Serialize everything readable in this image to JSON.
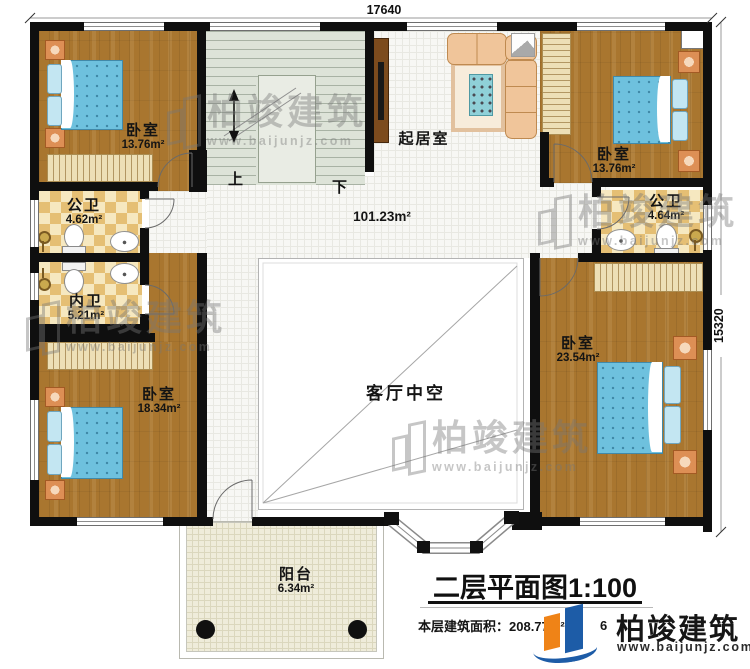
{
  "title": {
    "text": "二层平面图1:100"
  },
  "footer": {
    "area_label": "本层建筑面积：208.77m²",
    "obscured_fragment": "6"
  },
  "brand": {
    "name": "柏竣建筑",
    "url": "www.baijunjz.com"
  },
  "dimensions": {
    "top": "17640",
    "right": "15320"
  },
  "stairs": {
    "up": "上",
    "down": "下"
  },
  "rooms": [
    {
      "id": "bedroom-top-left",
      "name": "卧室",
      "area": "13.76m²"
    },
    {
      "id": "public-bath-left",
      "name": "公卫",
      "area": "4.62m²"
    },
    {
      "id": "private-bath-left",
      "name": "内卫",
      "area": "5.21m²"
    },
    {
      "id": "bedroom-bottom-left",
      "name": "卧室",
      "area": "18.34m²"
    },
    {
      "id": "living-room-upper",
      "name": "起居室",
      "area": ""
    },
    {
      "id": "bedroom-top-right",
      "name": "卧室",
      "area": "13.76m²"
    },
    {
      "id": "public-bath-right",
      "name": "公卫",
      "area": "4.64m²"
    },
    {
      "id": "bedroom-bottom-right",
      "name": "卧室",
      "area": "23.54m²"
    },
    {
      "id": "corridor",
      "name": "",
      "area": "101.23m²"
    },
    {
      "id": "living-void",
      "name": "客厅中空",
      "area": ""
    },
    {
      "id": "balcony",
      "name": "阳台",
      "area": "6.34m²"
    }
  ]
}
